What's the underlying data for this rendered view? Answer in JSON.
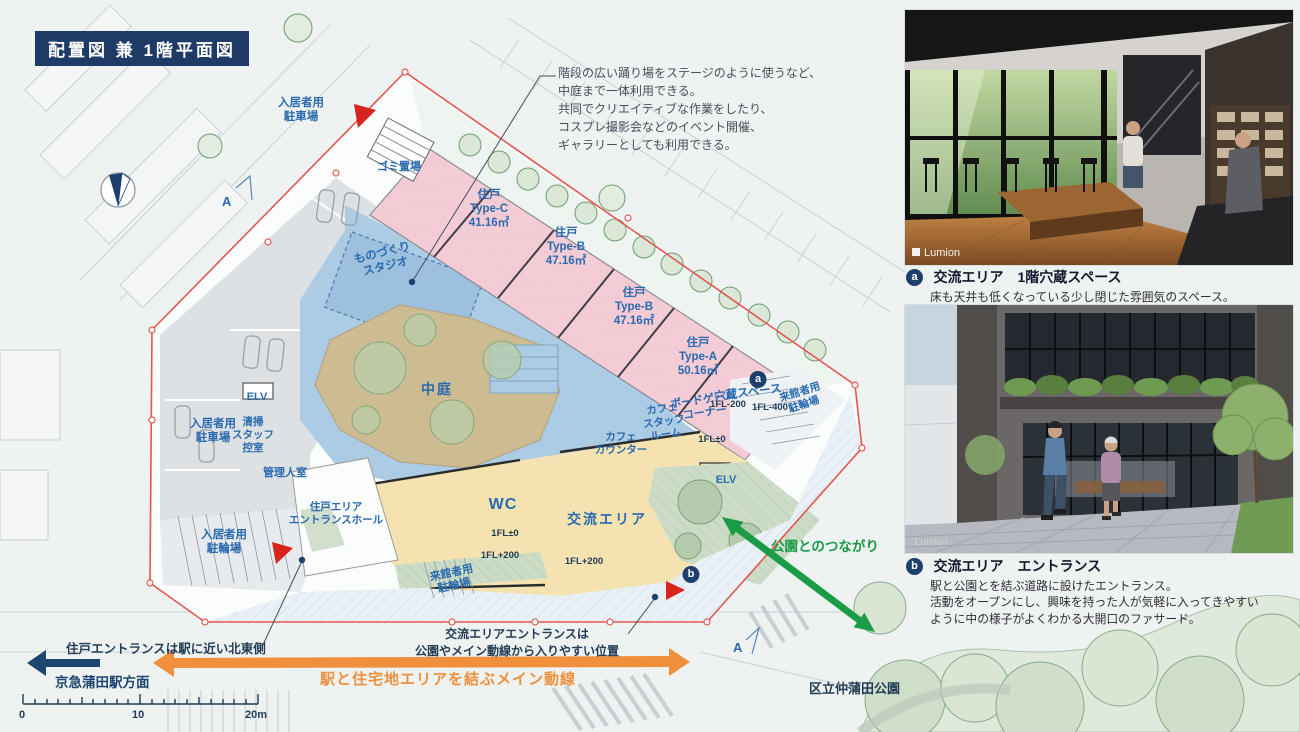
{
  "title": "配置図 兼 1階平面図",
  "stage_note": "階段の広い踊り場をステージのように使うなど、\n中庭まで一体利用できる。\n共同でクリエイティブな作業をしたり、\nコスプレ撮影会などのイベント開催、\nギャラリーとしても利用できる。",
  "plan": {
    "section_mark": "A",
    "badge_a": "a",
    "badge_b": "b",
    "labels": [
      "ゴミ置場",
      "住戸\nType-C\n41.16㎡",
      "住戸\nType-B\n47.16㎡",
      "住戸\nType-B\n47.16㎡",
      "住戸\nType-A\n50.16㎡",
      "ものづくり\nスタジオ",
      "入居者用\n駐車場",
      "入居者用\n駐車場",
      "入居者用\n駐輪場",
      "中庭",
      "ELV",
      "清掃\nスタッフ\n控室",
      "管理人室",
      "住戸エリア\nエントランスホール",
      "WC",
      "来館者用\n駐輪場",
      "交流エリア",
      "カフェ\nカウンター",
      "カフェ\nスタッフ\nルーム",
      "ボードゲーム\nコーナー",
      "穴蔵スペース",
      "1FL-200",
      "1FL-400",
      "来館者用\n駐輪場",
      "1FL±0",
      "ELV",
      "1FL±0",
      "1FL+200",
      "1FL+200"
    ]
  },
  "notes": {
    "unit_entrance": "住戸エントランスは駅に近い北東側",
    "exchange_entrance": "交流エリアエントランスは\n公園やメイン動線から入りやすい位置",
    "station": "京急蒲田駅方面",
    "main_line": "駅と住宅地エリアを結ぶメイン動線",
    "park_link": "公園とのつながり",
    "park_name": "区立仲蒲田公園"
  },
  "scale": {
    "labels": [
      "0",
      "10",
      "20m"
    ]
  },
  "photos": [
    {
      "badge": "a",
      "title": "交流エリア　1階穴蔵スペース",
      "desc": "床も天井も低くなっている少し閉じた雰囲気のスペース。",
      "watermark": "Lumion"
    },
    {
      "badge": "b",
      "title": "交流エリア　エントランス",
      "desc": "駅と公園とを結ぶ道路に設けたエントランス。\n活動をオープンにし、興味を持った人が気軽に入ってきやすい\nように中の様子がよくわかる大開口のファサード。",
      "watermark": "Lumion"
    }
  ],
  "colors": {
    "title_navy": "#1e3a66",
    "label_blue": "#2a6ab0",
    "unit_pink": "#f3ccd6",
    "shared_blue": "#accbe4",
    "exchange_yellow": "#f4e3b0",
    "courtyard_tan": "#cdbc92",
    "boundary_red": "#e2574f",
    "main_line_orange": "#f08f3c",
    "park_green": "#1a9c47"
  }
}
